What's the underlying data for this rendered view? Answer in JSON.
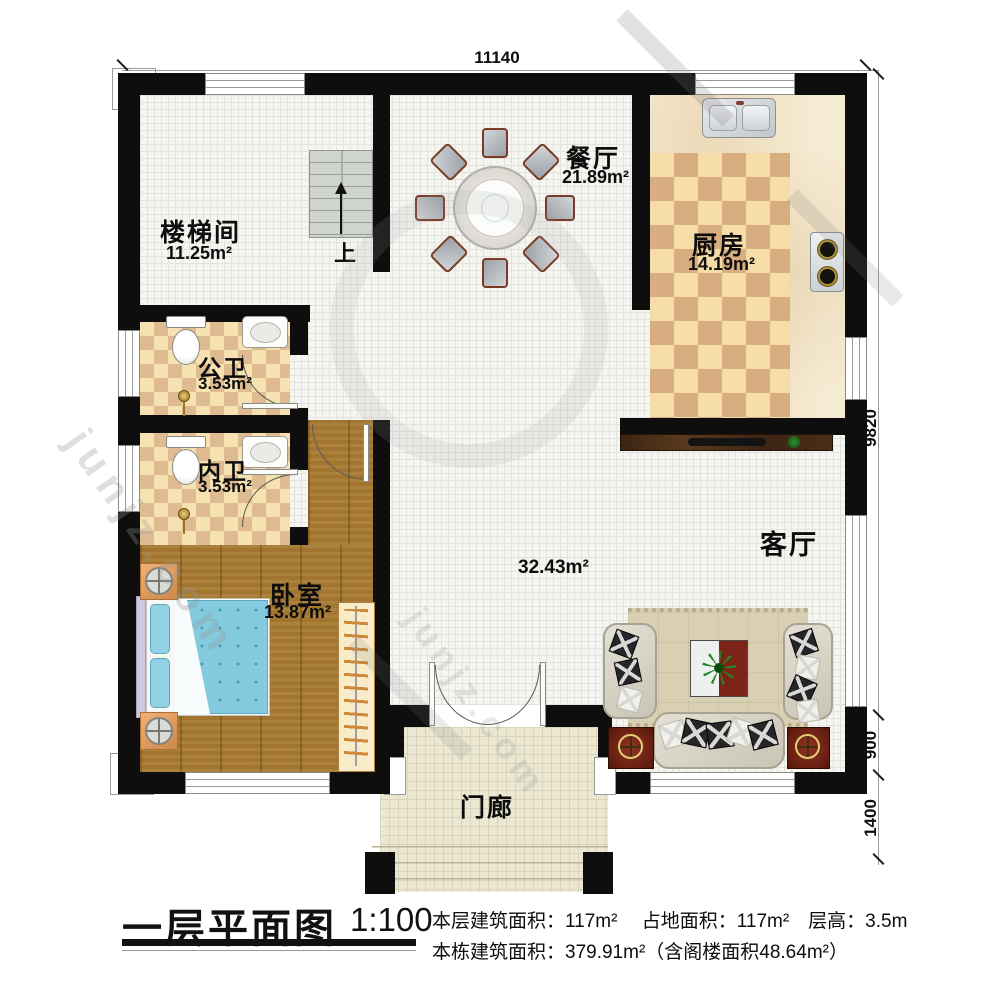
{
  "title_block": {
    "title": "一层平面图",
    "scale": "1:100",
    "line1": "本层建筑面积：117m²　 占地面积：117m²　层高：3.5m",
    "line2": "本栋建筑面积：379.91m²（含阁楼面积48.64m²）"
  },
  "dimensions": {
    "top": "11140",
    "right_upper": "9820",
    "right_mid": "900",
    "right_lower": "1400"
  },
  "rooms": {
    "stairwell": {
      "name": "楼梯间",
      "area": "11.25m²"
    },
    "dining": {
      "name": "餐厅",
      "area": "21.89m²"
    },
    "kitchen": {
      "name": "厨房",
      "area": "14.19m²"
    },
    "public_bath": {
      "name": "公卫",
      "area": "3.53m²"
    },
    "inner_bath": {
      "name": "内卫",
      "area": "3.53m²"
    },
    "bedroom": {
      "name": "卧室",
      "area": "13.87m²"
    },
    "living": {
      "name": "客厅",
      "area": "32.43m²"
    },
    "porch": {
      "name": "门廊"
    }
  },
  "stairs": {
    "up_label": "上"
  },
  "watermark": {
    "text": "junjz.com"
  },
  "colors": {
    "wall": "#0e0e0e",
    "wood_floor": "#a87a32",
    "kitchen_checker_light": "#f6dca6",
    "kitchen_checker_dark": "#d8ad80",
    "bed_duvet": "#84cbdf",
    "coffee_table_red": "#7c241a"
  }
}
